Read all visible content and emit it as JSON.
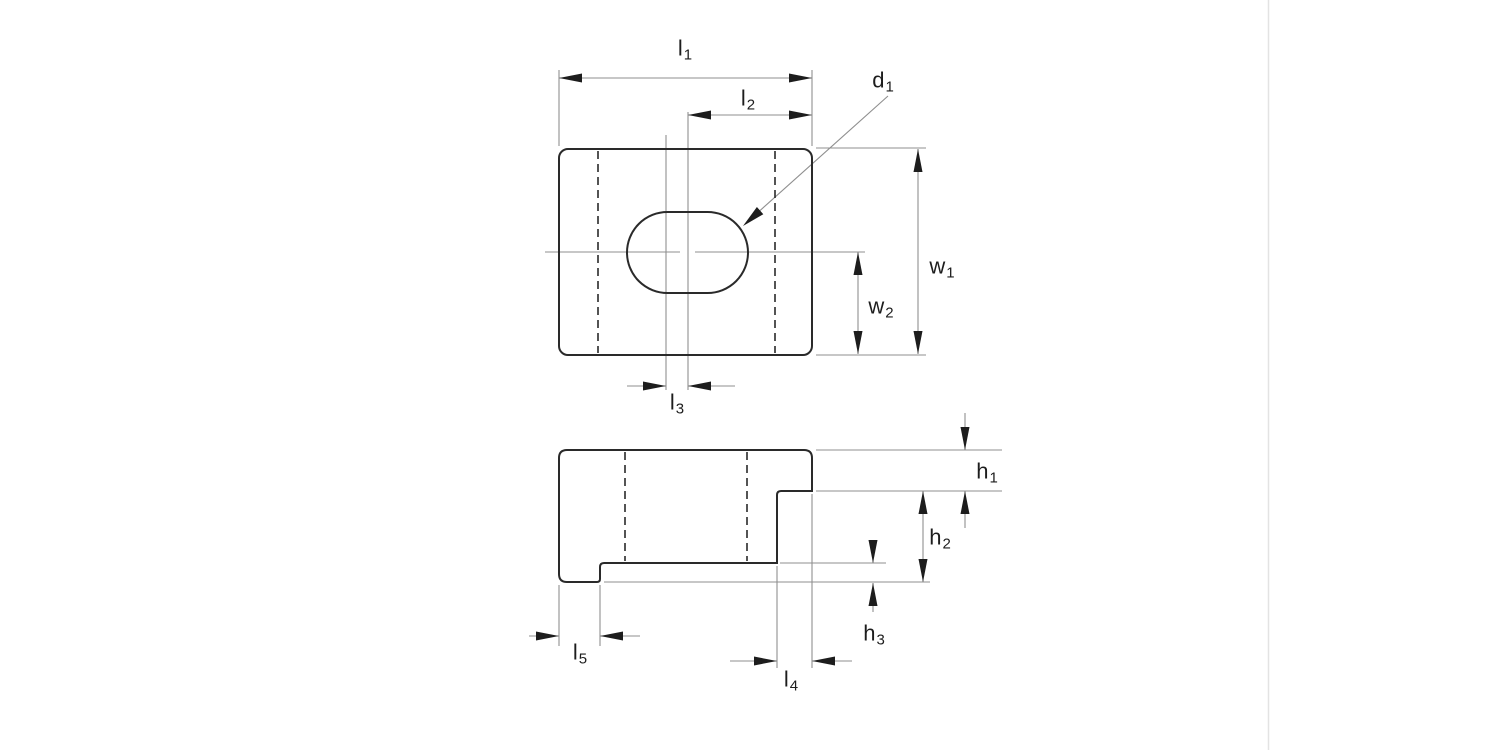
{
  "drawing": {
    "views": {
      "top_view": "top-view",
      "side_view": "side-view"
    },
    "labels": {
      "l1": {
        "base": "l",
        "sub": "1"
      },
      "l2": {
        "base": "l",
        "sub": "2"
      },
      "l3": {
        "base": "l",
        "sub": "3"
      },
      "l4": {
        "base": "l",
        "sub": "4"
      },
      "l5": {
        "base": "l",
        "sub": "5"
      },
      "w1": {
        "base": "w",
        "sub": "1"
      },
      "w2": {
        "base": "w",
        "sub": "2"
      },
      "h1": {
        "base": "h",
        "sub": "1"
      },
      "h2": {
        "base": "h",
        "sub": "2"
      },
      "h3": {
        "base": "h",
        "sub": "3"
      },
      "d1": {
        "base": "d",
        "sub": "1"
      }
    }
  },
  "colors": {
    "outline": "#2a2a2a",
    "hidden_line": "#2a2a2a",
    "thin_line": "#8f8f8f",
    "arrow": "#1d1d1d",
    "text": "#1d1d1d",
    "divider": "#e3e3e3",
    "background": "#ffffff"
  }
}
